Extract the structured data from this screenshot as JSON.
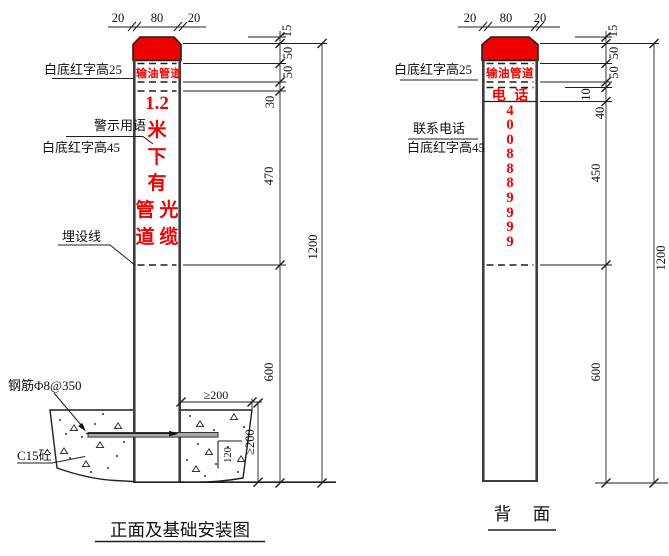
{
  "drawing": {
    "colors": {
      "cap_red": "#ee0000",
      "text_red": "#f40000",
      "line": "#1f1f1f"
    },
    "front": {
      "top_dims": [
        "20",
        "80",
        "20"
      ],
      "marker_text": {
        "band": "输油管道",
        "warning": "1.2\n米\n下\n有\n管 光\n道 缆"
      },
      "labels": {
        "band_note": "白底红字高25",
        "warning_note_1": "警示用语",
        "warning_note_2": "白底红字高45",
        "burial_line": "埋设线",
        "rebar": "钢筋Φ8@350",
        "concrete": "C15砼"
      },
      "dims": {
        "cap": "15",
        "s50a": "50",
        "s50b": "50",
        "gap": "30",
        "warn_zone": "470",
        "buried": "600",
        "total": "1200",
        "found_w": "≥200",
        "found_h": "≥200",
        "rebar_off": "120"
      },
      "title": "正面及基础安装图"
    },
    "back": {
      "top_dims": [
        "20",
        "80",
        "20"
      ],
      "marker_text": {
        "band": "输油管道",
        "phone_label": "电 话",
        "phone_digits": "4\n0\n0\n8\n8\n8\n9\n9\n9\n9"
      },
      "labels": {
        "band_note": "白底红字高25",
        "phone_note_1": "联系电话",
        "phone_note_2": "白底红字高45"
      },
      "dims": {
        "cap": "15",
        "s50a": "50",
        "s50b": "50",
        "gap": "10",
        "phone_band": "40",
        "digits_zone": "450",
        "buried": "600",
        "total": "1200"
      },
      "title": "背　面"
    }
  }
}
